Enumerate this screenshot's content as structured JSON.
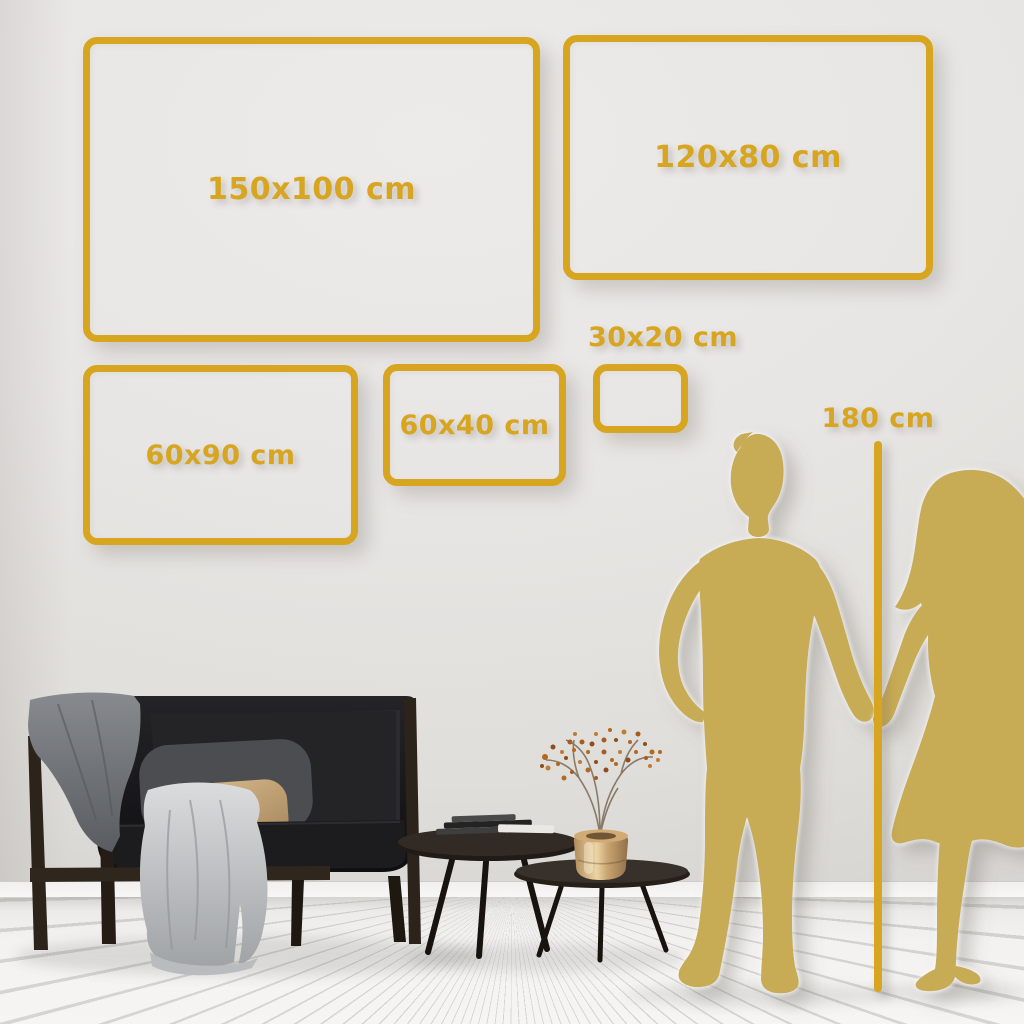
{
  "size_frames": [
    {
      "id": "150x100",
      "label": "150x100 cm"
    },
    {
      "id": "120x80",
      "label": "120x80 cm"
    },
    {
      "id": "60x90",
      "label": "60x90 cm"
    },
    {
      "id": "60x40",
      "label": "60x40 cm"
    },
    {
      "id": "30x20",
      "label": "30x20 cm"
    }
  ],
  "height_marker": {
    "label": "180 cm"
  },
  "colors": {
    "accent_gold": "#D7A51F",
    "silhouette_gold": "#C8AB55",
    "wall": "#E7E5E3",
    "floor": "#F4F3F1",
    "sofa_dark": "#1A1A1C",
    "pillow_tan": "#CDAB7E",
    "blanket_gray": "#9DA0A3",
    "wood_dark": "#2C231B",
    "vase_brass": "#C8A471",
    "blossom_rust": "#B2691F"
  },
  "scene": {
    "figures": [
      "man-silhouette",
      "woman-silhouette"
    ],
    "furniture": [
      "sofa",
      "gray-blanket",
      "tan-pillow",
      "nesting-coffee-tables",
      "books",
      "brass-vase",
      "dried-branch"
    ]
  }
}
